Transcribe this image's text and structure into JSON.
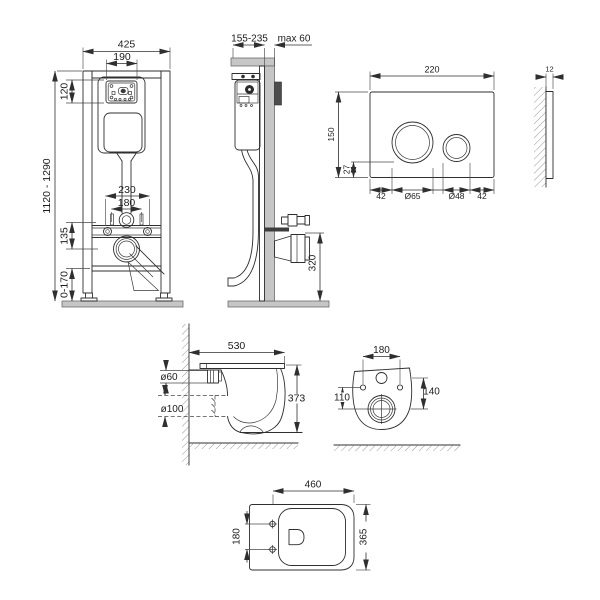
{
  "title": "Wall-hung toilet installation dimensions diagram",
  "colors": {
    "line": "#2f2f2f",
    "wall_gray": "#c6c6c6",
    "dark_plate": "#4d4d4d",
    "background": "#ffffff"
  },
  "frame_front": {
    "width": "425",
    "cistern_width": "190",
    "access_height": "120",
    "height_range": "1120 - 1290",
    "bolt_spacing_outer": "230",
    "bolt_spacing_inner": "180",
    "outlet_offset": "135",
    "foot_adjust": "0-170"
  },
  "frame_side": {
    "depth": "155-235",
    "max_offset": "max 60",
    "outlet_height": "320"
  },
  "flush_plate": {
    "width": "220",
    "height": "150",
    "button_offset": "27",
    "margin_left": "42",
    "big_button": "Ø65",
    "small_button": "Ø48",
    "margin_right": "42",
    "thickness": "12"
  },
  "bowl_side": {
    "depth": "530",
    "inlet": "ø60",
    "outlet": "ø100",
    "height": "373"
  },
  "bowl_rear": {
    "bolt_spacing": "180",
    "outlet_drop": "110",
    "inlet_drop": "140"
  },
  "bowl_bottom": {
    "depth": "460",
    "bolt_spacing": "180",
    "width": "365"
  }
}
